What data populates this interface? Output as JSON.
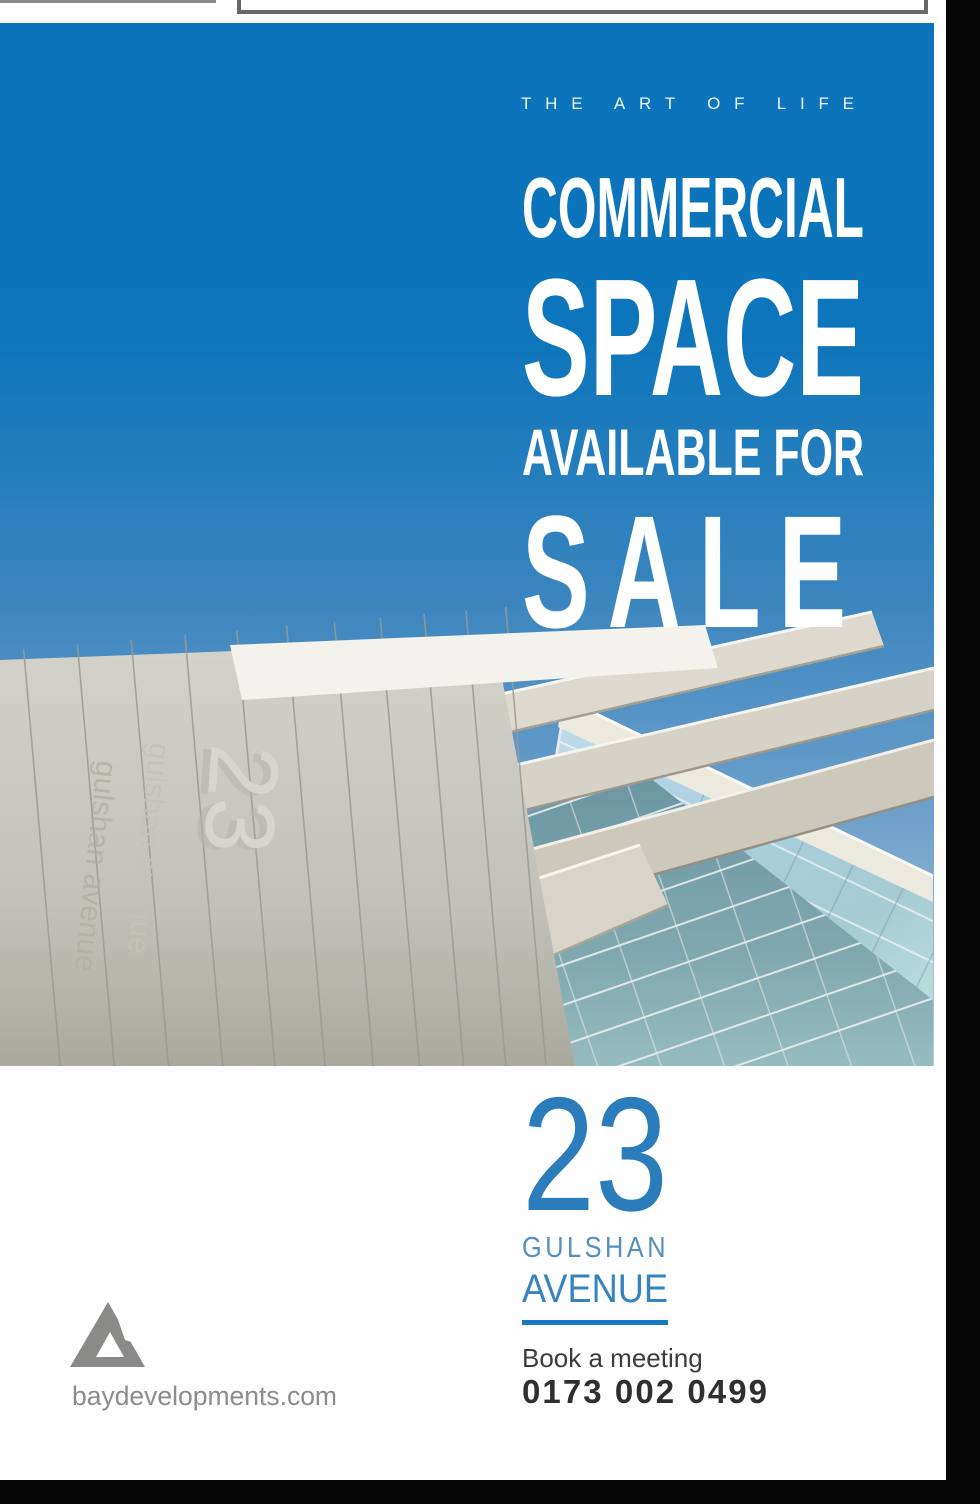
{
  "poster": {
    "tagline": "THE ART OF LIFE",
    "headline": {
      "line1": "COMMERCIAL",
      "line2": "SPACE",
      "line3": "AVAILABLE FOR",
      "line4": "SALE"
    },
    "address": {
      "number": "23",
      "street": "GULSHAN",
      "street2": "AVENUE"
    },
    "cta": {
      "label": "Book a meeting",
      "phone": "0173 002 0499"
    },
    "brand": {
      "website": "baydevelopments.com",
      "logo": "bay-triangle-logo"
    },
    "building_sign": {
      "number": "23",
      "street": "gulshan avenue"
    },
    "colors": {
      "primary_blue": "#0a73b9",
      "sky_light": "#b2d2de",
      "accent_rule_blue": "#1a78be",
      "address_blue": "#2b7cba",
      "text_dark": "#3c3c3c",
      "brand_gray": "#8a8a88",
      "page_white": "#fdfefd",
      "canvas_black": "#050505"
    }
  }
}
